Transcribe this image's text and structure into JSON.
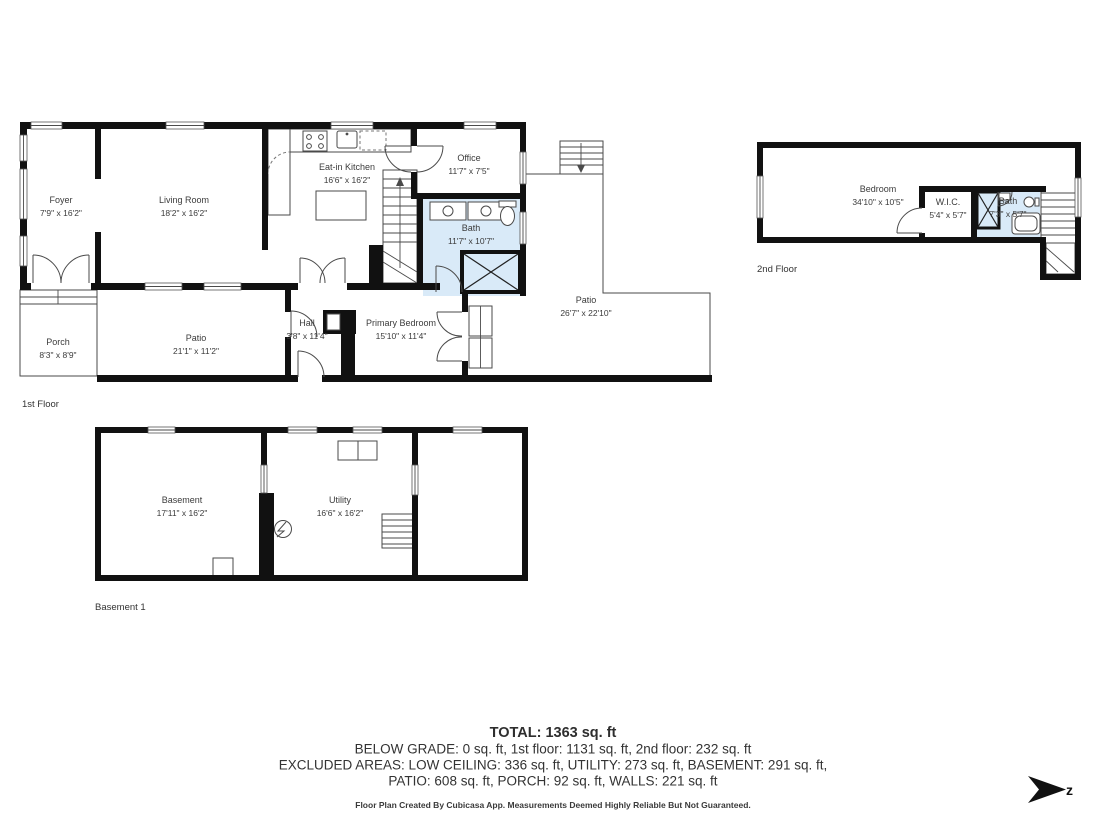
{
  "colors": {
    "wall": "#111111",
    "wet_room_fill": "#d9eaf8",
    "label_text": "#3b3b3b"
  },
  "floors": {
    "first": {
      "label": "1st Floor",
      "rooms": {
        "foyer": {
          "name": "Foyer",
          "dims": "7'9\" x 16'2\""
        },
        "living": {
          "name": "Living Room",
          "dims": "18'2\" x 16'2\""
        },
        "kitchen": {
          "name": "Eat-in Kitchen",
          "dims": "16'6\" x 16'2\""
        },
        "office": {
          "name": "Office",
          "dims": "11'7\" x 7'5\""
        },
        "bath": {
          "name": "Bath",
          "dims": "11'7\" x 10'7\""
        },
        "porch": {
          "name": "Porch",
          "dims": "8'3\" x 8'9\""
        },
        "patio": {
          "name": "Patio",
          "dims": "21'1\" x 11'2\""
        },
        "hall": {
          "name": "Hall",
          "dims": "3'8\" x 11'4\""
        },
        "primary_bedroom": {
          "name": "Primary Bedroom",
          "dims": "15'10\" x 11'4\""
        },
        "patio_large": {
          "name": "Patio",
          "dims": "26'7\" x 22'10\""
        }
      }
    },
    "second": {
      "label": "2nd Floor",
      "rooms": {
        "bedroom": {
          "name": "Bedroom",
          "dims": "34'10\" x 10'5\""
        },
        "wic": {
          "name": "W.I.C.",
          "dims": "5'4\" x 5'7\""
        },
        "bath": {
          "name": "Bath",
          "dims": "7'3\" x 5'7\""
        }
      }
    },
    "basement": {
      "label": "Basement 1",
      "rooms": {
        "basement": {
          "name": "Basement",
          "dims": "17'11\" x 16'2\""
        },
        "utility": {
          "name": "Utility",
          "dims": "16'6\" x 16'2\""
        }
      }
    }
  },
  "summary": {
    "total": "TOTAL: 1363 sq. ft",
    "below_grade_line": "BELOW GRADE: 0 sq. ft, 1st floor: 1131 sq. ft, 2nd floor: 232 sq. ft",
    "excluded_line_1": "EXCLUDED AREAS: LOW CEILING: 336 sq. ft, UTILITY: 273 sq. ft, BASEMENT: 291 sq. ft,",
    "excluded_line_2": "PATIO: 608 sq. ft, PORCH: 92 sq. ft, WALLS: 221 sq. ft",
    "disclaimer": "Floor Plan Created By Cubicasa App. Measurements Deemed Highly Reliable But Not Guaranteed."
  },
  "compass": {
    "label": "z"
  }
}
